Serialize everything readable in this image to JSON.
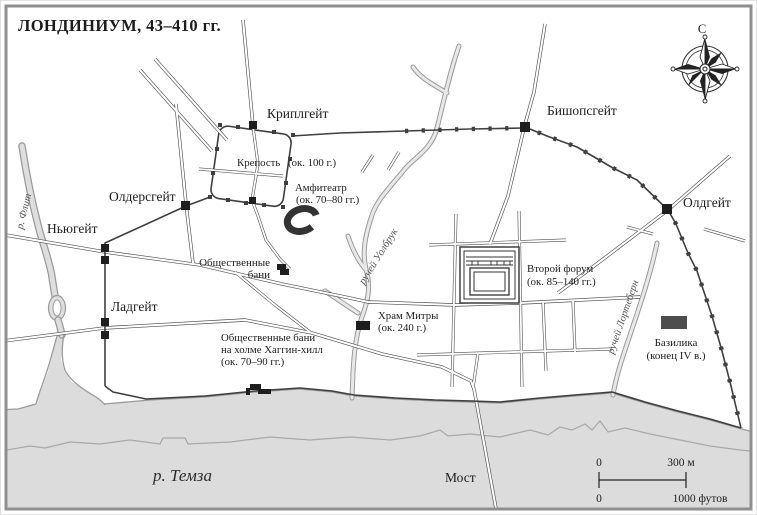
{
  "title": "ЛОНДИНИУМ, 43–410 гг.",
  "compass": {
    "north": "С"
  },
  "gates": {
    "cripplegate": "Криплгейт",
    "bishopsgate": "Бишопсгейт",
    "aldgate": "Олдгейт",
    "aldersgate": "Олдерсгейт",
    "newgate": "Ньюгейт",
    "ludgate": "Ладгейт"
  },
  "features": {
    "fortress": {
      "name": "Крепость",
      "date": "(ок. 100 г.)"
    },
    "amphitheatre": {
      "name": "Амфитеатр",
      "date": "(ок. 70–80 гг.)"
    },
    "public_baths": {
      "line1": "Общественные",
      "line2": "бани"
    },
    "mithras_temple": {
      "name": "Храм Митры",
      "date": "(ок. 240 г.)"
    },
    "second_forum": {
      "name": "Второй форум",
      "date": "(ок. 85–140 гг.)"
    },
    "basilica": {
      "name": "Базилика",
      "date": "(конец IV в.)"
    },
    "huggin_hill_baths": {
      "line1": "Общественные бани",
      "line2": "на холме Хаггин-хилл",
      "line3": "(ок. 70–90 гг.)"
    },
    "bridge": "Мост"
  },
  "waterways": {
    "thames": "р. Темза",
    "fleet": "р. Флит",
    "walbrook": "ручей Уолбрук",
    "lorteburn": "ручей Лортеберн"
  },
  "scale_bar": {
    "meters_zero": "0",
    "meters_max": "300 м",
    "feet_zero": "0",
    "feet_max": "1000 футов"
  },
  "colors": {
    "water": "#dcdcdc",
    "wall": "#3f3f3f",
    "frame": "#8f8f8f",
    "road_casing": "#4f4f4f",
    "stream_edge": "#9a9a9a",
    "text": "#1c1c1c"
  }
}
